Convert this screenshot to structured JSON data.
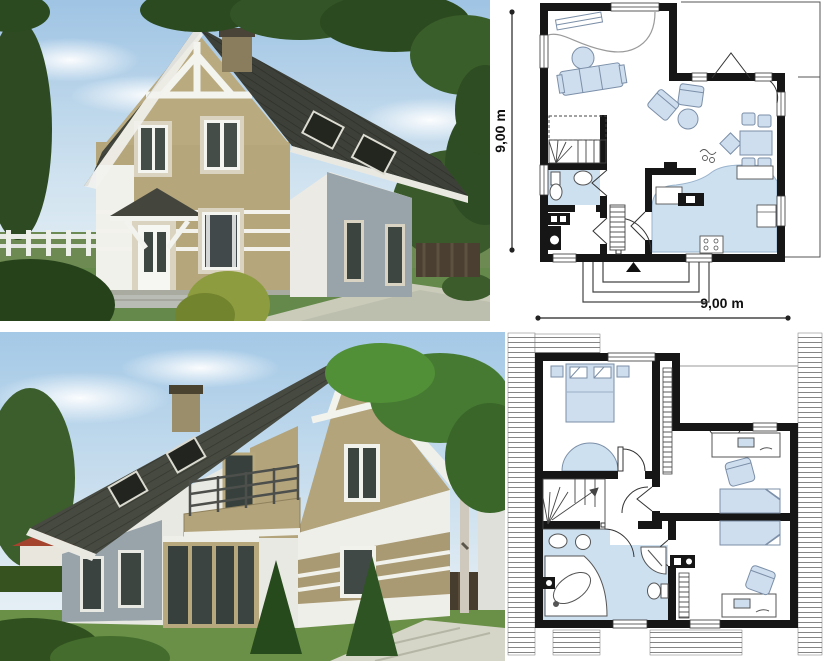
{
  "collage": {
    "type": "house project presentation collage",
    "panels": [
      "front exterior render",
      "ground floor plan",
      "rear exterior render",
      "attic floor plan"
    ]
  },
  "plans": {
    "ground": {
      "name": "ground-floor-plan",
      "width_label": "9,00 m",
      "height_label": "9,00 m",
      "rooms": [
        "living room",
        "dining area",
        "kitchen",
        "hall",
        "bathroom",
        "utility room",
        "stairs",
        "entry porch",
        "corner terrace"
      ],
      "furniture": [
        "sofa",
        "coffee table",
        "armchairs",
        "dining table with chairs",
        "kitchen counters",
        "fridge",
        "stove",
        "sink",
        "toilet",
        "washbasin",
        "wardrobe"
      ]
    },
    "upper": {
      "name": "attic-floor-plan",
      "rooms": [
        "bedroom 1",
        "bedroom 2",
        "bedroom 3",
        "bathroom",
        "hall",
        "stairs"
      ],
      "furniture": [
        "double bed",
        "two single beds",
        "two desks with chairs",
        "wardrobes",
        "corner bathtub",
        "shower",
        "two washbasins",
        "toilet"
      ]
    }
  },
  "colors": {
    "plan_wall": "#161616",
    "plan_furniture_fill": "#cfdeee",
    "plan_furniture_stroke": "#7b8fa8",
    "plan_floor_blue": "#cde0f0",
    "roof_dark": "#3d4038",
    "wall_white": "#f1f1ec",
    "wall_beige": "#b5a67c",
    "wall_grey_blue": "#98a4aa",
    "sky_top": "#9fc4e4",
    "sky_bottom": "#eef4f7",
    "grass": "#64894a",
    "foliage_dark": "#2b4a1f",
    "path_light": "#cbcbba",
    "neighbor_roof_red": "#a4442f"
  }
}
